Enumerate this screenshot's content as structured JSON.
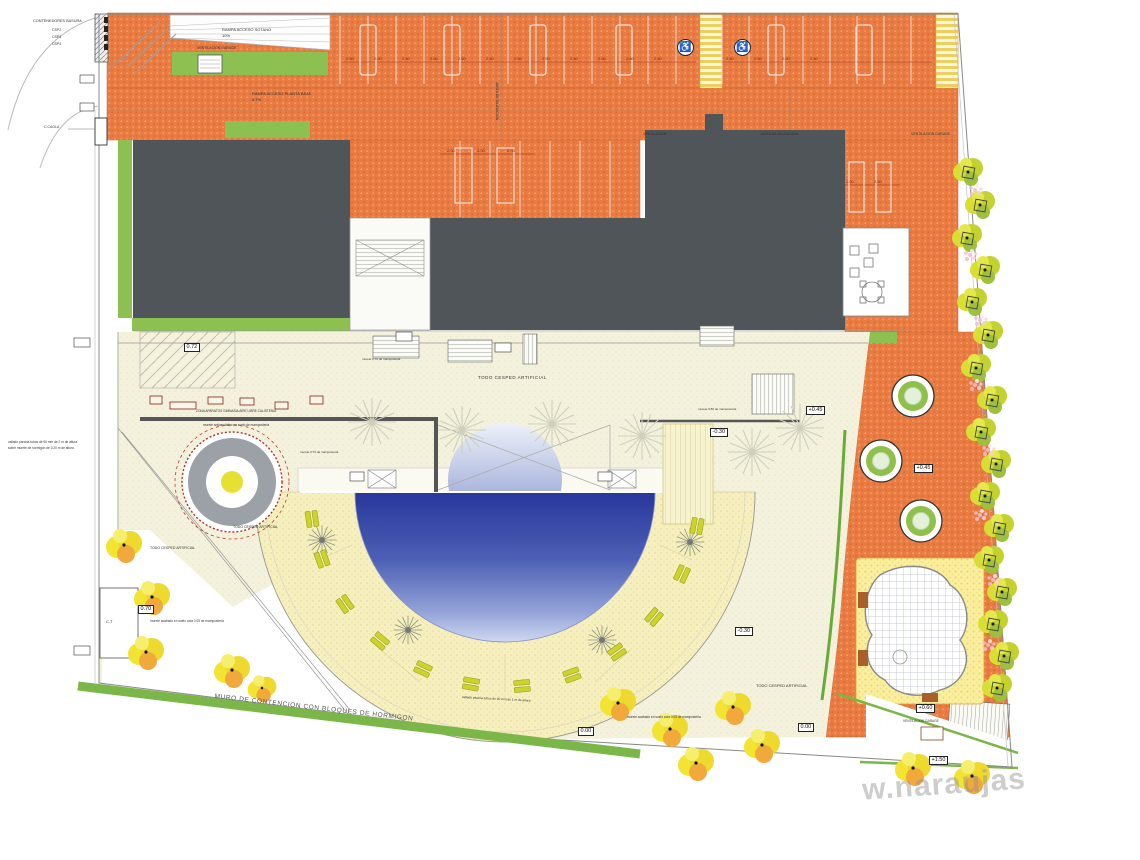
{
  "plan_type": "landscape-site-plan",
  "labels": {
    "contenedores": "CONTENEDORES BASURA",
    "csp2": "CSP2",
    "csp3": "CSP3",
    "csp4": "CSP4",
    "ccaola": "C.CAOLA",
    "rampa_sotano": "RAMPA ACCESO SOTANO",
    "rampa_sotano_slope": "10%",
    "vent_garage_left": "VENTILACION GARAGE",
    "rampa_pb": "RAMPA ACCESO PLANTA BAJA",
    "rampa_pb_slope": "5.7%",
    "ventilacion": "VENTILACION",
    "junta": "JUNTA DE DILATACION",
    "junta_vertical": "JUNTA DE DILATACION",
    "vent_garage_right": "VENTILACION GARAGE",
    "cesped": "TODO CESPED ARTIFICIAL",
    "zona_aparatos": "ZONA APARATOS GIMNASIA AIRE LIBRE CALISTENIA",
    "murete_antivandalico": "murete antivandalico en suelo de mamposteria",
    "murete_080": "murete 0.80 de mamposteria",
    "murete_070": "murete 0.70 de mamposteria",
    "murete_005": "murete acabado en suelo cota 0.05 de mamposteria",
    "vallado_parcela_1": "vallado parcela tubos de 60 mm de 2 m de altura",
    "vallado_parcela_2": "sobre murete de hormigon de 0.20 m de altura",
    "vallado_piscina": "vallado piscina tubos de 60 mm de 1 m de altura",
    "muro_contencion": "MURO DE CONTENCION  CON BLOQUES DE HORMIGON",
    "vent_garage_bottom": "VENTILACION GARAGE",
    "ct": "C.T",
    "watermark": "w.naraujas"
  },
  "markers": {
    "p045": "+0.45",
    "m030": "-0.30",
    "p060": "+0.60",
    "p150": "+1.50",
    "zero": "0.00",
    "p072": "0.72",
    "p070": "0.70"
  },
  "dims": {
    "stall": "2.50"
  },
  "icons": {
    "handicap": "♿"
  },
  "colors": {
    "orange_deck": "#e87c42",
    "building_gray": "#50555a",
    "terrace_cream": "#f4f2dc",
    "pool_deck_sand": "#f6efbf",
    "pool_blue_dark": "#27379b",
    "pool_blue_light": "#cfd8f0",
    "green": "#8cc152",
    "tree_yellow": "#f2e431",
    "tree_lime": "#c3d22e",
    "playground_yellow": "#f9ef9f"
  }
}
